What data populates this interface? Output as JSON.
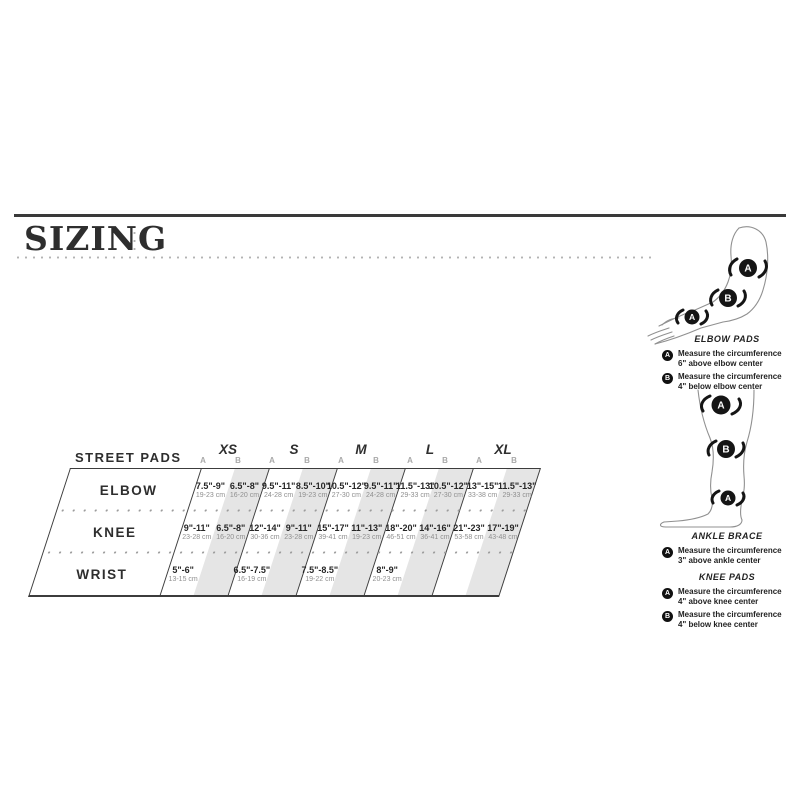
{
  "page": {
    "title": "SIZING"
  },
  "colors": {
    "band": "#e5e5e5",
    "text": "#262626",
    "muted": "#8f8f8f",
    "line": "#3c3c3c"
  },
  "markers": {
    "a": "A",
    "b": "B"
  },
  "table": {
    "label": "STREET PADS",
    "sizes": [
      "XS",
      "S",
      "M",
      "L",
      "XL"
    ],
    "ab": [
      "A",
      "B"
    ],
    "row_headers": [
      "ELBOW",
      "KNEE",
      "WRIST"
    ],
    "rows": [
      {
        "name": "ELBOW",
        "cells": [
          {
            "in": "7.5\"-9\"",
            "cm": "19-23 cm"
          },
          {
            "in": "6.5\"-8\"",
            "cm": "16-20 cm"
          },
          {
            "in": "9.5\"-11\"",
            "cm": "24-28 cm"
          },
          {
            "in": "8.5\"-10\"",
            "cm": "19-23 cm"
          },
          {
            "in": "10.5\"-12\"",
            "cm": "27-30 cm"
          },
          {
            "in": "9.5\"-11\"",
            "cm": "24-28 cm"
          },
          {
            "in": "11.5\"-13\"",
            "cm": "29-33 cm"
          },
          {
            "in": "10.5\"-12\"",
            "cm": "27-30 cm"
          },
          {
            "in": "13\"-15\"",
            "cm": "33-38 cm"
          },
          {
            "in": "11.5\"-13\"",
            "cm": "29-33 cm"
          }
        ]
      },
      {
        "name": "KNEE",
        "cells": [
          {
            "in": "9\"-11\"",
            "cm": "23-28 cm"
          },
          {
            "in": "6.5\"-8\"",
            "cm": "16-20 cm"
          },
          {
            "in": "12\"-14\"",
            "cm": "30-36 cm"
          },
          {
            "in": "9\"-11\"",
            "cm": "23-28 cm"
          },
          {
            "in": "15\"-17\"",
            "cm": "39-41 cm"
          },
          {
            "in": "11\"-13\"",
            "cm": "19-23 cm"
          },
          {
            "in": "18\"-20\"",
            "cm": "46-51 cm"
          },
          {
            "in": "14\"-16\"",
            "cm": "36-41 cm"
          },
          {
            "in": "21\"-23\"",
            "cm": "53-58 cm"
          },
          {
            "in": "17\"-19\"",
            "cm": "43-48 cm"
          }
        ]
      },
      {
        "name": "WRIST",
        "cells": [
          {
            "in": "5\"-6\"",
            "cm": "13-15 cm"
          },
          {
            "in": "",
            "cm": ""
          },
          {
            "in": "6.5\"-7.5\"",
            "cm": "16-19 cm"
          },
          {
            "in": "",
            "cm": ""
          },
          {
            "in": "7.5\"-8.5\"",
            "cm": "19-22 cm"
          },
          {
            "in": "",
            "cm": ""
          },
          {
            "in": "8\"-9\"",
            "cm": "20-23 cm"
          },
          {
            "in": "",
            "cm": ""
          },
          {
            "in": "",
            "cm": ""
          },
          {
            "in": "",
            "cm": ""
          }
        ]
      }
    ]
  },
  "guides": {
    "elbow_pads": {
      "title": "ELBOW PADS",
      "items": [
        {
          "marker": "A",
          "line1": "Measure the circumference",
          "line2": "6\" above elbow center"
        },
        {
          "marker": "B",
          "line1": "Measure the circumference",
          "line2": "4\" below elbow center"
        }
      ]
    },
    "ankle_brace": {
      "title": "ANKLE BRACE",
      "items": [
        {
          "marker": "A",
          "line1": "Measure the circumference",
          "line2": "3\" above ankle center"
        }
      ]
    },
    "knee_pads": {
      "title": "KNEE PADS",
      "items": [
        {
          "marker": "A",
          "line1": "Measure the circumference",
          "line2": "4\" above knee center"
        },
        {
          "marker": "B",
          "line1": "Measure the circumference",
          "line2": "4\" below knee center"
        }
      ]
    }
  }
}
